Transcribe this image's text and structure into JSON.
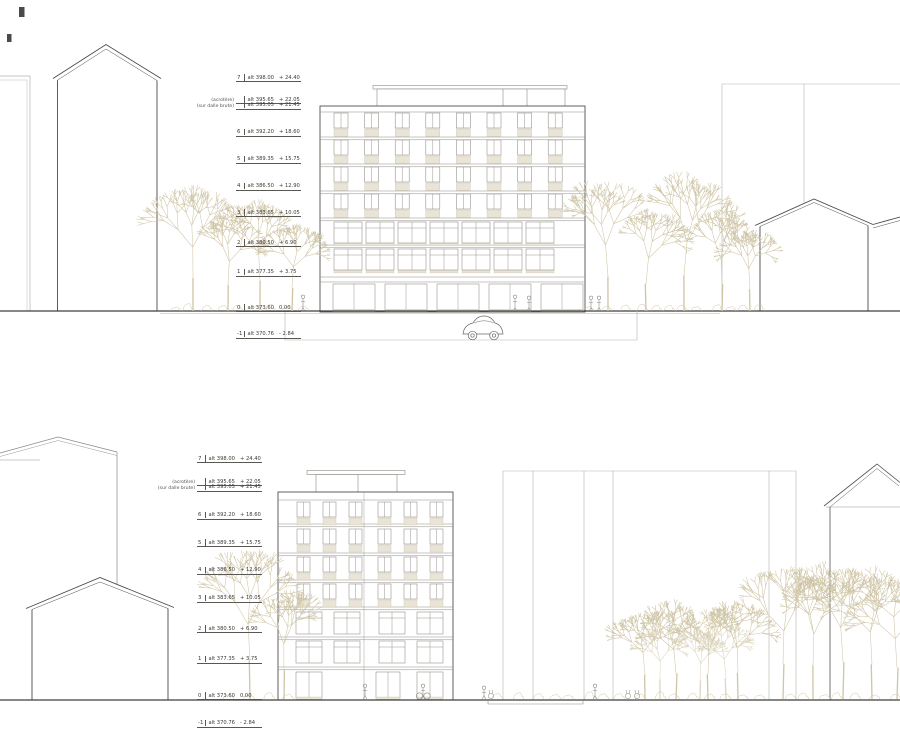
{
  "colors": {
    "line_dark": "#4a4a48",
    "line_mid": "#77756f",
    "line_light": "#b5b2ac",
    "frame": "#8d8a84",
    "tree": "#cfc5a6",
    "tree_light": "#ddd6c0",
    "panel": "#e9e4d6",
    "panel_edge": "#cbc5b3",
    "ground": "#3f3d3a",
    "text": "#3a3a38"
  },
  "icons": {
    "car": "car-silhouette",
    "person": "person-silhouette",
    "rabbit": "rabbit-silhouette",
    "tree": "bare-tree"
  },
  "elevations": [
    {
      "id": "top",
      "levels": [
        {
          "label": "7",
          "pre": "",
          "alt": "alt 398.00",
          "rel": "+ 24.40",
          "rel_m": 24.4
        },
        {
          "label": "",
          "pre": "(acrotère)",
          "alt": "alt 395.65",
          "rel": "+ 22.05",
          "rel_m": 22.05
        },
        {
          "label": "",
          "pre": "(sur dalle brute)",
          "alt": "alt 395.05",
          "rel": "+ 21.45",
          "rel_m": 21.45
        },
        {
          "label": "6",
          "pre": "",
          "alt": "alt 392.20",
          "rel": "+ 18.60",
          "rel_m": 18.6
        },
        {
          "label": "5",
          "pre": "",
          "alt": "alt 389.35",
          "rel": "+ 15.75",
          "rel_m": 15.75
        },
        {
          "label": "4",
          "pre": "",
          "alt": "alt 386.50",
          "rel": "+ 12.90",
          "rel_m": 12.9
        },
        {
          "label": "3",
          "pre": "",
          "alt": "alt 383.65",
          "rel": "+ 10.05",
          "rel_m": 10.05
        },
        {
          "label": "2",
          "pre": "",
          "alt": "alt 380.50",
          "rel": "+ 6.90",
          "rel_m": 6.9
        },
        {
          "label": "1",
          "pre": "",
          "alt": "alt 377.35",
          "rel": "+ 3.75",
          "rel_m": 3.75
        },
        {
          "label": "0",
          "pre": "",
          "alt": "alt 373.60",
          "rel": "0.00",
          "rel_m": 0
        },
        {
          "label": "-1",
          "pre": "",
          "alt": "alt 370.76",
          "rel": "- 2.84",
          "rel_m": -2.84
        }
      ]
    },
    {
      "id": "bottom",
      "levels": [
        {
          "label": "7",
          "pre": "",
          "alt": "alt 398.00",
          "rel": "+ 24.40",
          "rel_m": 24.4
        },
        {
          "label": "",
          "pre": "(acrotère)",
          "alt": "alt 395.65",
          "rel": "+ 22.05",
          "rel_m": 22.05
        },
        {
          "label": "",
          "pre": "(sur dalle brute)",
          "alt": "alt 395.05",
          "rel": "+ 21.45",
          "rel_m": 21.45
        },
        {
          "label": "6",
          "pre": "",
          "alt": "alt 392.20",
          "rel": "+ 18.60",
          "rel_m": 18.6
        },
        {
          "label": "5",
          "pre": "",
          "alt": "alt 389.35",
          "rel": "+ 15.75",
          "rel_m": 15.75
        },
        {
          "label": "4",
          "pre": "",
          "alt": "alt 386.50",
          "rel": "+ 12.90",
          "rel_m": 12.9
        },
        {
          "label": "3",
          "pre": "",
          "alt": "alt 383.65",
          "rel": "+ 10.05",
          "rel_m": 10.05
        },
        {
          "label": "2",
          "pre": "",
          "alt": "alt 380.50",
          "rel": "+ 6.90",
          "rel_m": 6.9
        },
        {
          "label": "1",
          "pre": "",
          "alt": "alt 377.35",
          "rel": "+ 3.75",
          "rel_m": 3.75
        },
        {
          "label": "0",
          "pre": "",
          "alt": "alt 373.60",
          "rel": "0.00",
          "rel_m": 0
        },
        {
          "label": "-1",
          "pre": "",
          "alt": "alt 370.76",
          "rel": "- 2.84",
          "rel_m": -2.84
        }
      ]
    }
  ]
}
